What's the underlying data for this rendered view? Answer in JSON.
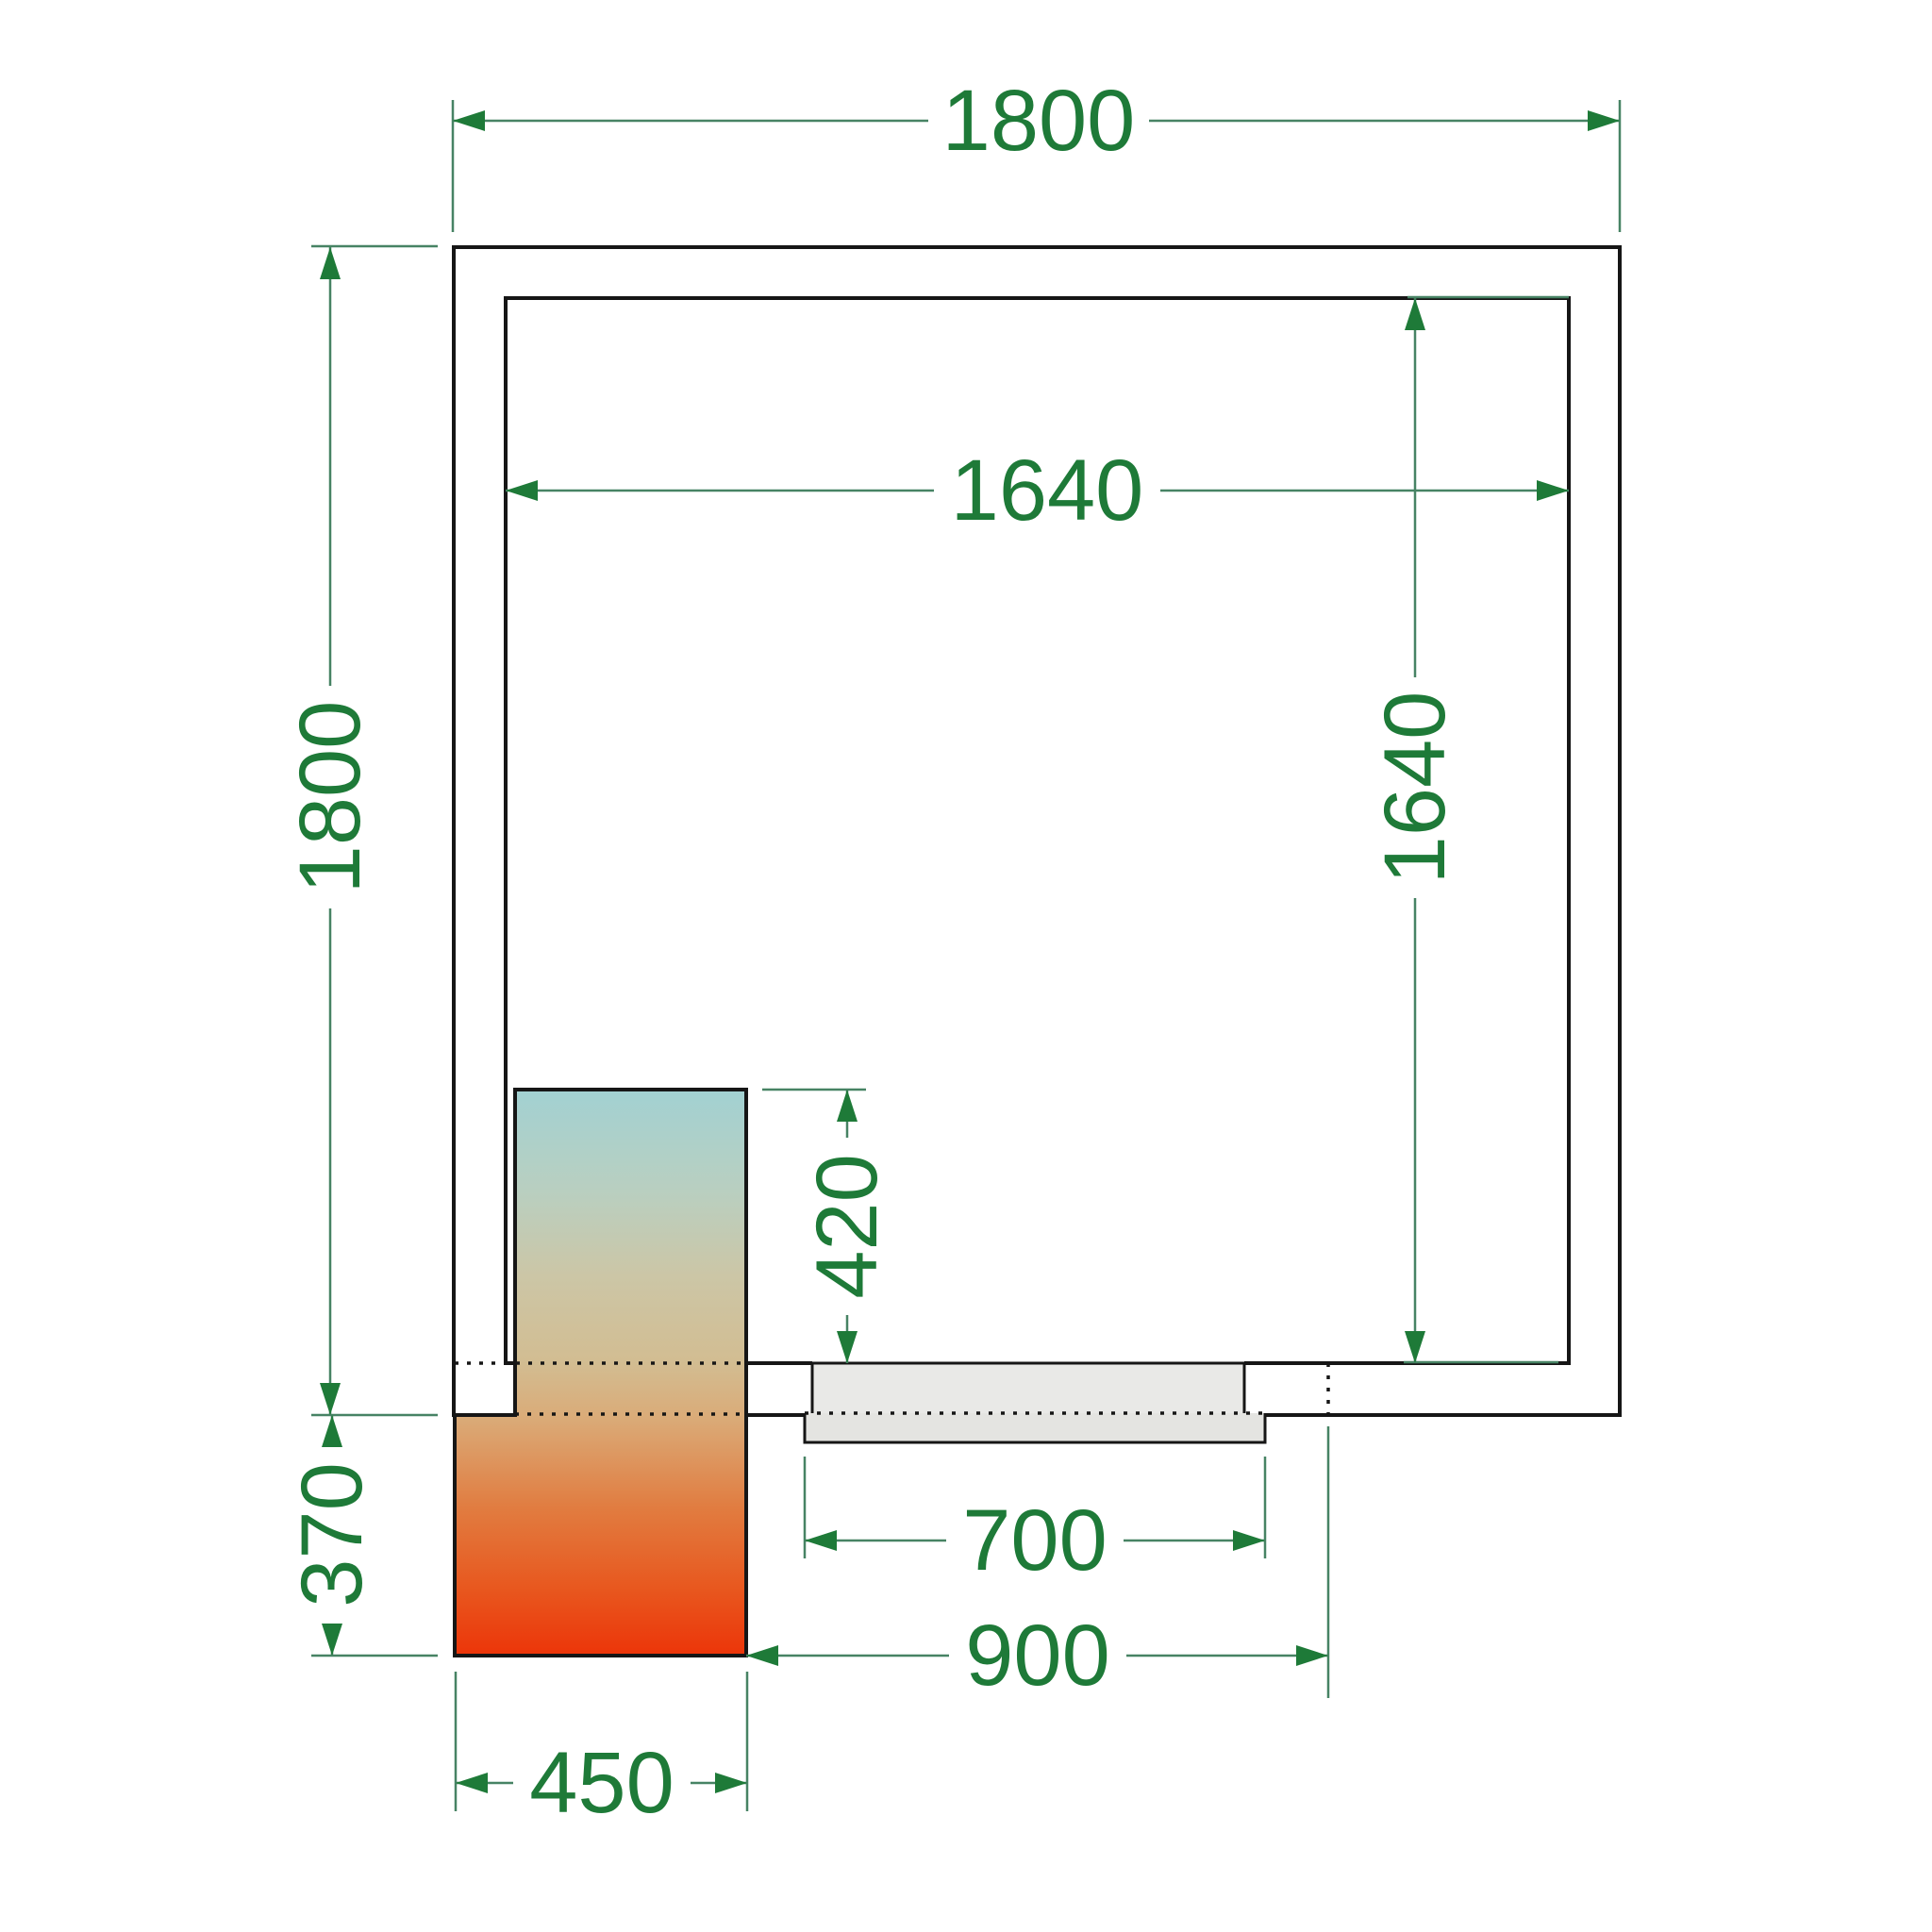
{
  "palette": {
    "background": "#ffffff",
    "wall_black": "#161616",
    "dimension_green": "#1e7a38",
    "dimension_line_green": "#478364",
    "door_gray_upper": "#e9e9e7",
    "door_gray_lower": "#e4e4e1",
    "unit_teal": "#a2d1d2",
    "unit_sage": "#b9cfc0",
    "unit_khaki": "#ccc6a6",
    "unit_tan": "#d2bd92",
    "unit_caramel": "#daab78",
    "unit_orange": "#e17c40",
    "unit_ember": "#e8581f",
    "unit_red": "#ec3509"
  },
  "dimensions": {
    "outer_width": "1800",
    "outer_height": "1800",
    "inner_width": "1640",
    "inner_height": "1640",
    "unit_inside_depth": "420",
    "unit_outside_depth": "370",
    "door_leaf_width": "700",
    "door_clearance_width": "900",
    "unit_width": "450"
  }
}
